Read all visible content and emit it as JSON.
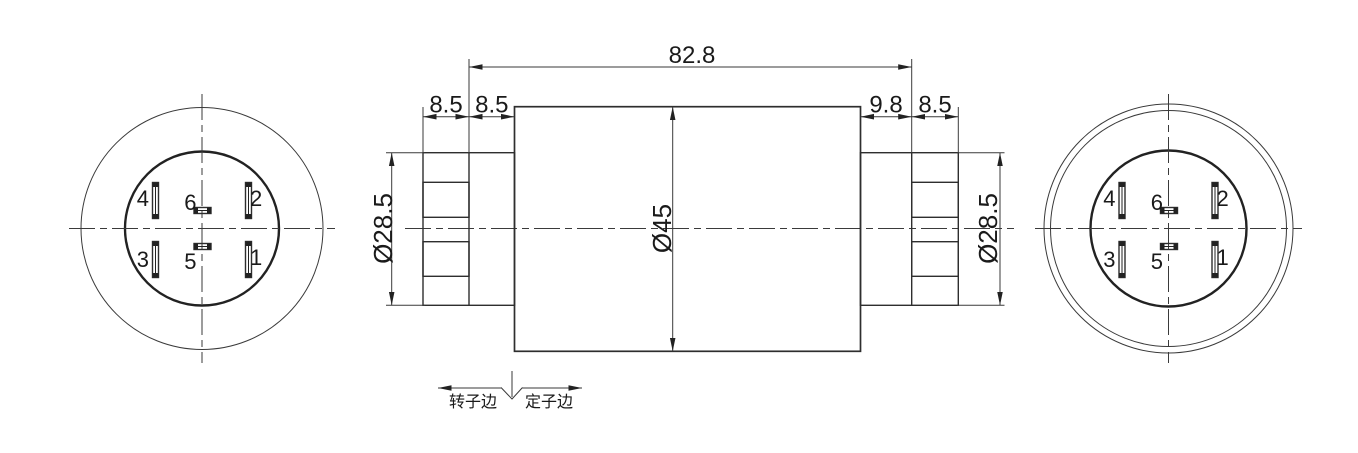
{
  "colors": {
    "line": "#2e2e2e",
    "thin_line": "#3a3a3a",
    "text": "#1a1a1a",
    "background": "#ffffff"
  },
  "left_view": {
    "slot_labels": {
      "top_left": "4",
      "top_right": "2",
      "center_top": "6",
      "center_bottom": "5",
      "bottom_left": "3",
      "bottom_right": "1"
    }
  },
  "right_view": {
    "slot_labels": {
      "top_left": "4",
      "top_right": "2",
      "center_top": "6",
      "center_bottom": "5",
      "bottom_left": "3",
      "bottom_right": "1"
    }
  },
  "side_view": {
    "dimensions": {
      "overall_length": "82.8",
      "left_outer_section": "8.5",
      "left_inner_section": "8.5",
      "right_inner_section": "9.8",
      "right_outer_section": "8.5",
      "left_end_diameter": "Ø28.5",
      "body_diameter": "Ø45",
      "right_end_diameter": "Ø28.5"
    },
    "boundary_note": {
      "rotor_side": "转子边",
      "stator_side": "定子边"
    }
  }
}
